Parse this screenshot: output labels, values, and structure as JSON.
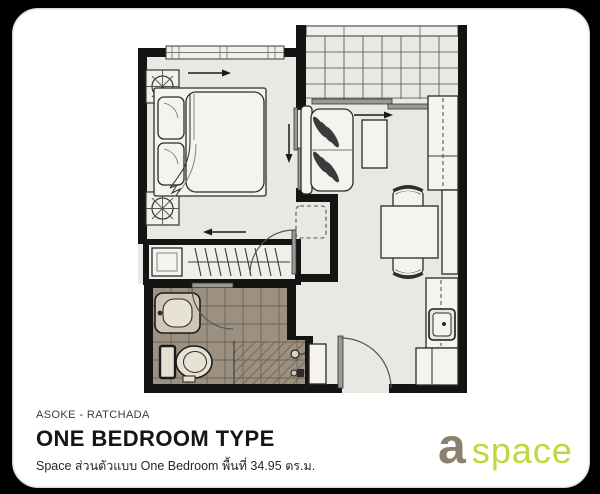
{
  "footer": {
    "location": "ASOKE - RATCHADA",
    "title": "ONE BEDROOM TYPE",
    "description": "Space  ส่วนตัวแบบ One Bedroom พื้นที่ 34.95 ตร.ม."
  },
  "logo": {
    "a": "a",
    "space": "space"
  },
  "colors": {
    "logo-a": "#8a8171",
    "logo-space": "#c0d83c",
    "wall": "#141414",
    "floor": "#e9e8e2",
    "bath-tile": "#9c9080",
    "bath-grout": "#6e6557"
  }
}
